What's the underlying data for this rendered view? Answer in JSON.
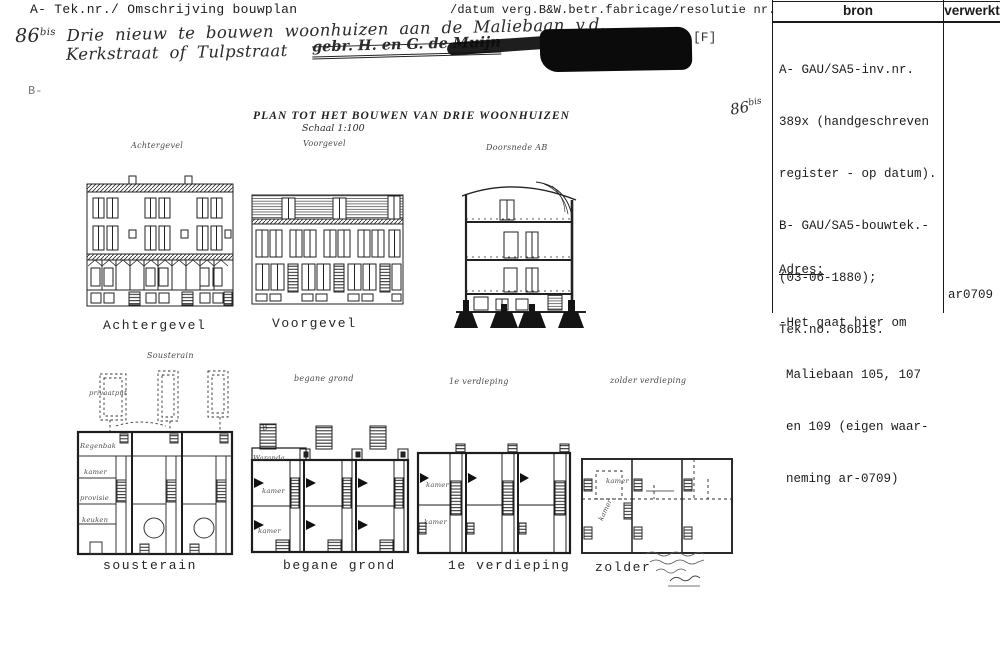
{
  "header": {
    "left": "A- Tek.nr./ Omschrijving bouwplan",
    "right": "/datum verg.B&W.betr.fabricage/resolutie nr.",
    "bron": "bron",
    "verwerkt": "verwerkt"
  },
  "annotations": {
    "number": "86",
    "number_sup": "bis",
    "line1": "Drie nieuw te bouwen woonhuizen aan de Maliebaan  v.d.",
    "line2": "Kerkstraat of Tulpstraat",
    "crossed_out": "gebr. H. en G. de Muijn",
    "redaction_tag": "[F]",
    "b_mark": "B-",
    "bis_script": "86",
    "bis_script_sup": "bis"
  },
  "bron_column": {
    "lines": [
      "A- GAU/SA5-inv.nr.",
      "389x (handgeschreven",
      "register - op datum).",
      "B- GAU/SA5-bouwtek.-",
      "(03-06-1880);",
      "Tek.no. 86bis."
    ],
    "adres_heading": "Adres:",
    "adres_lines": [
      "-Het gaat hier om",
      "Maliebaan 105, 107",
      "en 109 (eigen waar-",
      "neming ar-0709)"
    ]
  },
  "verwerkt_column": {
    "value": "ar0709"
  },
  "sheet": {
    "title": "PLAN TOT HET BOUWEN VAN DRIE WOONHUIZEN",
    "scale": "Schaal 1:100",
    "hand_labels": {
      "achtergevel": "Achtergevel",
      "voorgevel": "Voorgevel",
      "doorsnede": "Doorsnede AB",
      "sousterain": "Sousterain",
      "privaatput": "privaatput",
      "begane_grond": "begane grond",
      "verdieping": "1e verdieping",
      "zolder": "zolder verdieping",
      "b_marker": "B"
    },
    "typed_labels": {
      "achtergevel": "Achtergevel",
      "voorgevel": "Voorgevel",
      "sousterain": "sousterain",
      "begane_grond": "begane grond",
      "verdieping": "1e verdieping",
      "zolder": "zolder"
    },
    "room_labels": {
      "regenbak": "Regenbak",
      "kamer": "kamer",
      "provisie": "provisie",
      "keuken": "keuken",
      "waranda": "Waranda"
    }
  }
}
